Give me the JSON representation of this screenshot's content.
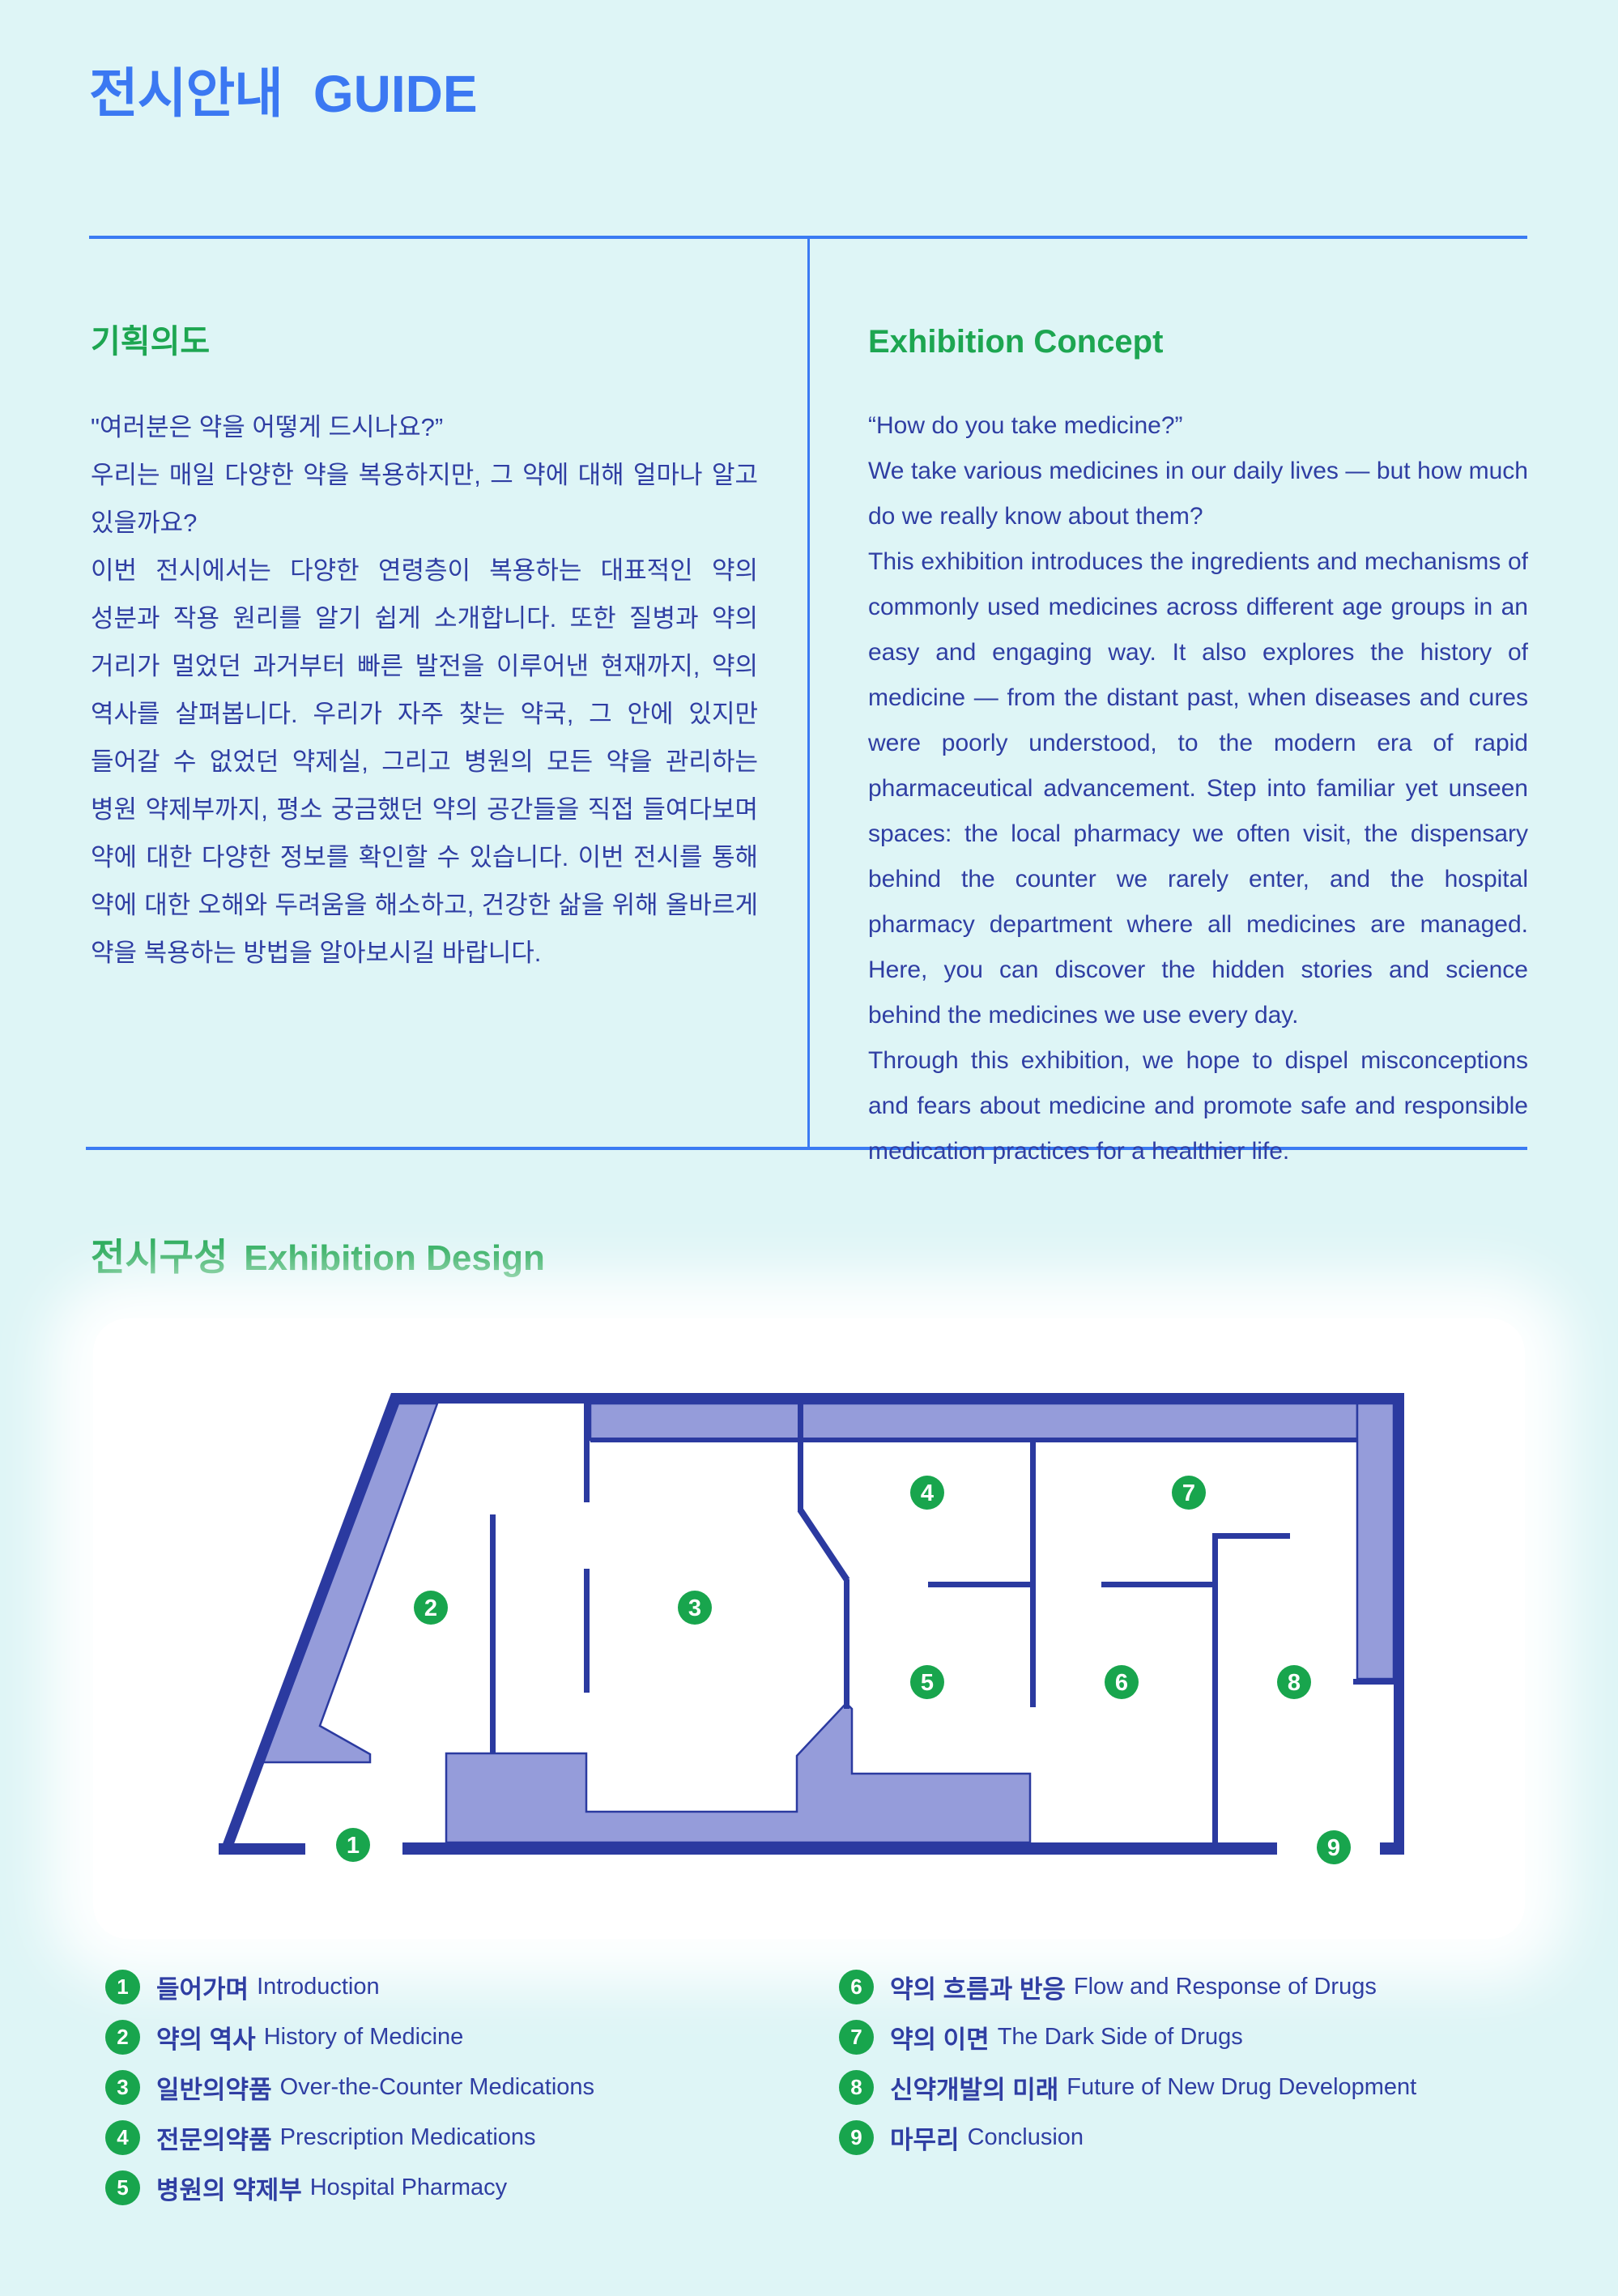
{
  "page": {
    "title_ko": "전시안내",
    "title_en": "GUIDE"
  },
  "colors": {
    "page_bg": "#DEF5F6",
    "accent_blue": "#3B78F2",
    "heading_green": "#1DA651",
    "body_navy": "#2F3EA3",
    "wall_navy": "#2B3AA0",
    "room_purple": "#959CDA",
    "marker_green": "#18A54D"
  },
  "concept": {
    "heading_ko": "기획의도",
    "heading_en": "Exhibition Concept",
    "ko": {
      "p1": "\"여러분은 약을 어떻게 드시나요?”",
      "p2": "우리는 매일 다양한 약을 복용하지만, 그 약에 대해 얼마나 알고 있을까요?",
      "p3": "이번 전시에서는 다양한 연령층이 복용하는 대표적인 약의 성분과 작용 원리를 알기 쉽게 소개합니다. 또한 질병과 약의 거리가 멀었던 과거부터 빠른 발전을 이루어낸 현재까지, 약의 역사를 살펴봅니다. 우리가 자주 찾는 약국, 그 안에 있지만 들어갈 수 없었던 약제실, 그리고 병원의 모든 약을 관리하는 병원 약제부까지, 평소 궁금했던 약의 공간들을 직접 들여다보며 약에 대한 다양한 정보를 확인할 수 있습니다.",
      "p4": "이번 전시를 통해 약에 대한 오해와 두려움을 해소하고, 건강한 삶을 위해 올바르게 약을 복용하는 방법을 알아보시길 바랍니다."
    },
    "en": {
      "p1": "“How do you take medicine?”",
      "p2": "We take various medicines in our daily lives — but how much do we really know about them?",
      "p3": "This exhibition introduces the ingredients and mechanisms of commonly used medicines across different age groups in an easy and engaging way. It also explores the history of medicine — from the distant past, when diseases and cures were poorly understood, to the modern era of rapid pharmaceutical advancement. Step into familiar yet unseen spaces: the local pharmacy we often visit, the dispensary behind the counter we rarely enter, and the hospital pharmacy department where all medicines are managed. Here, you can discover the hidden stories and science behind the medicines we use every day.",
      "p4": "Through this exhibition, we hope to dispel misconceptions and fears about medicine and promote safe and responsible medication practices for a healthier life."
    }
  },
  "design": {
    "heading_ko": "전시구성",
    "heading_en": "Exhibition Design"
  },
  "map": {
    "markers": [
      {
        "num": "1"
      },
      {
        "num": "2"
      },
      {
        "num": "3"
      },
      {
        "num": "4"
      },
      {
        "num": "5"
      },
      {
        "num": "6"
      },
      {
        "num": "7"
      },
      {
        "num": "8"
      },
      {
        "num": "9"
      }
    ]
  },
  "legend": {
    "items": [
      {
        "num": "1",
        "ko": "들어가며",
        "en": "Introduction"
      },
      {
        "num": "2",
        "ko": "약의 역사",
        "en": "History of Medicine"
      },
      {
        "num": "3",
        "ko": "일반의약품",
        "en": "Over-the-Counter Medications"
      },
      {
        "num": "4",
        "ko": "전문의약품",
        "en": "Prescription Medications"
      },
      {
        "num": "5",
        "ko": "병원의 약제부",
        "en": "Hospital Pharmacy"
      },
      {
        "num": "6",
        "ko": "약의 흐름과 반응",
        "en": "Flow and Response of Drugs"
      },
      {
        "num": "7",
        "ko": "약의 이면",
        "en": "The Dark Side of Drugs"
      },
      {
        "num": "8",
        "ko": "신약개발의 미래",
        "en": "Future of New Drug Development"
      },
      {
        "num": "9",
        "ko": "마무리",
        "en": "Conclusion"
      }
    ]
  }
}
